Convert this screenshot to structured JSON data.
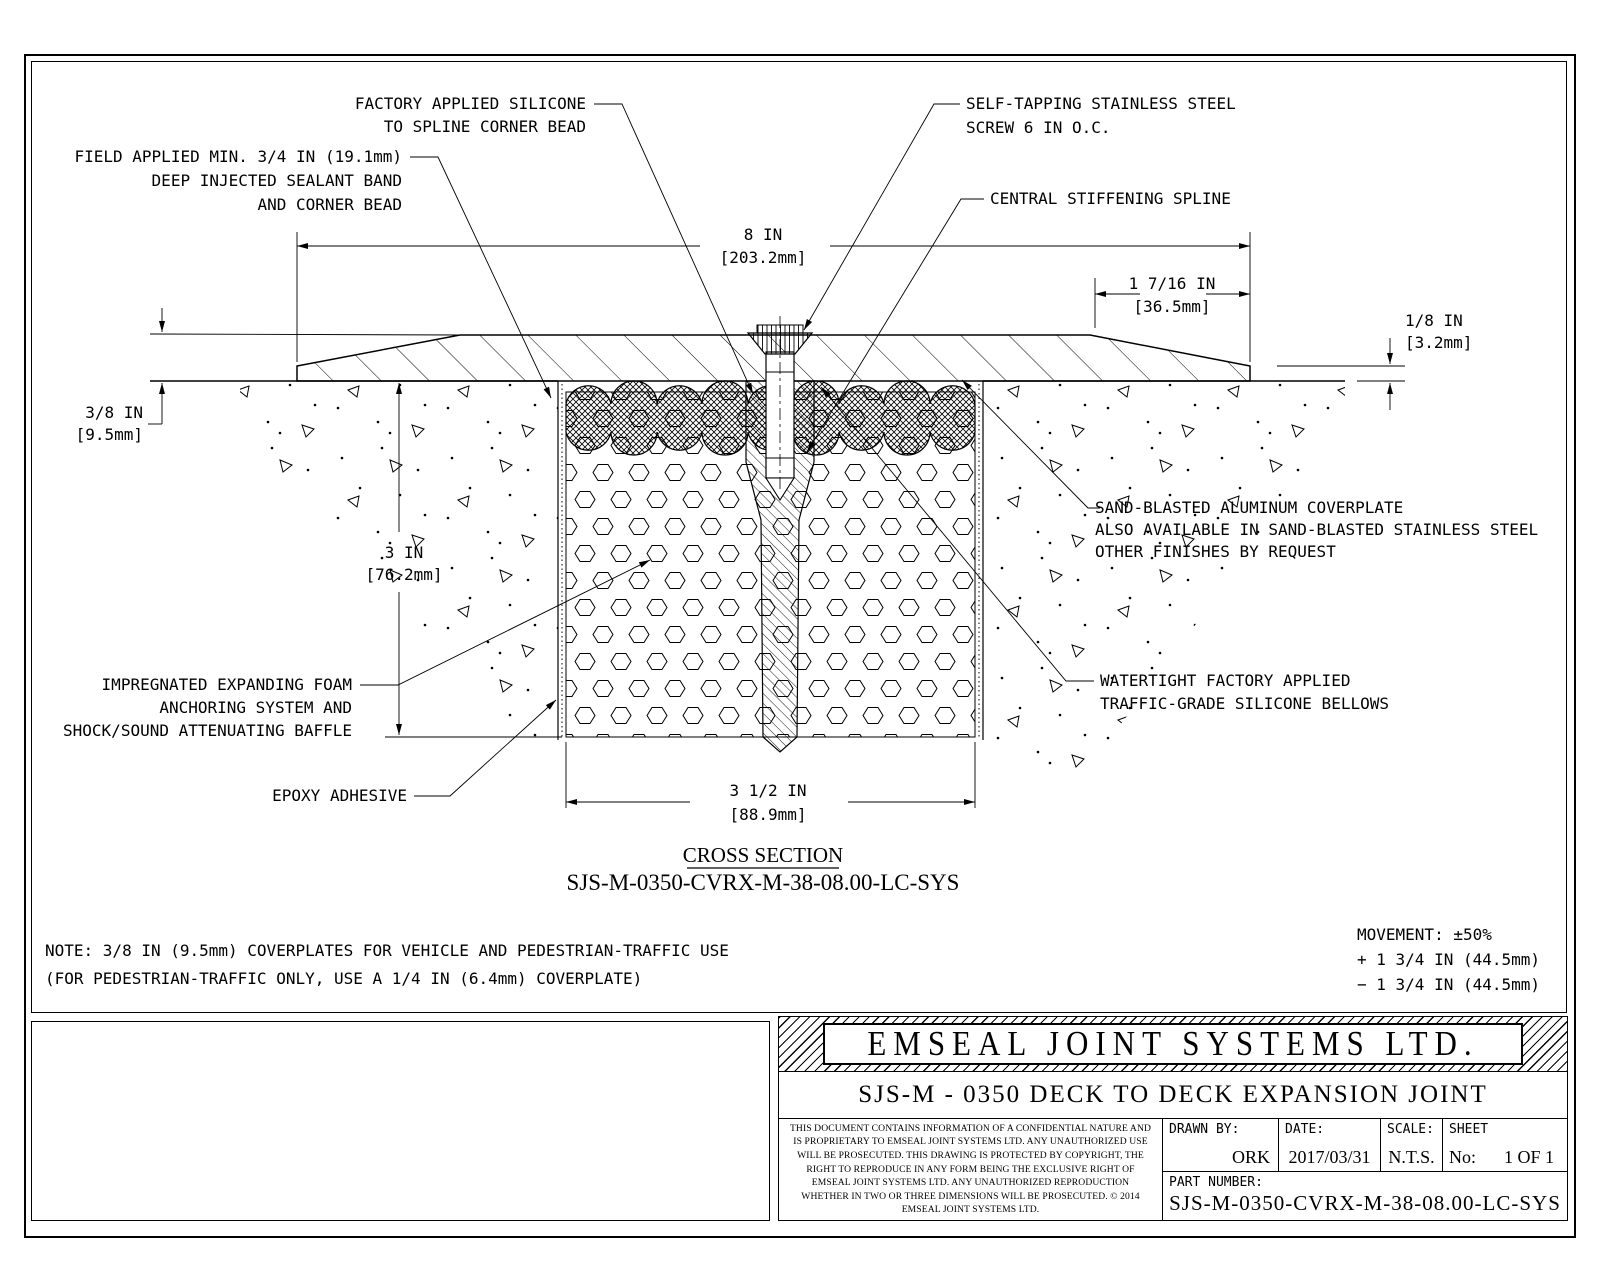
{
  "drawing": {
    "callouts": {
      "factory_applied": {
        "lines": [
          "FACTORY APPLIED SILICONE",
          "TO SPLINE CORNER BEAD"
        ]
      },
      "field_applied": {
        "lines": [
          "FIELD APPLIED MIN. 3/4 IN (19.1mm)",
          "DEEP INJECTED SEALANT BAND",
          "AND CORNER BEAD"
        ]
      },
      "self_tapping_screw": {
        "lines": [
          "SELF-TAPPING STAINLESS STEEL",
          "SCREW 6 IN O.C."
        ]
      },
      "central_spline": {
        "lines": [
          "CENTRAL STIFFENING SPLINE"
        ]
      },
      "coverplate": {
        "lines": [
          "SAND-BLASTED ALUMINUM COVERPLATE",
          "ALSO AVAILABLE IN SAND-BLASTED STAINLESS STEEL",
          "OTHER FINISHES BY REQUEST"
        ]
      },
      "bellows": {
        "lines": [
          "WATERTIGHT FACTORY APPLIED",
          "TRAFFIC-GRADE SILICONE BELLOWS"
        ]
      },
      "foam": {
        "lines": [
          "IMPREGNATED EXPANDING FOAM",
          "ANCHORING SYSTEM AND",
          "SHOCK/SOUND ATTENUATING BAFFLE"
        ]
      },
      "epoxy": {
        "lines": [
          "EPOXY ADHESIVE"
        ]
      }
    },
    "dimensions": {
      "overall_width": {
        "value": "8 IN",
        "metric": "[203.2mm]"
      },
      "taper_width": {
        "value": "1 7/16 IN",
        "metric": "[36.5mm]"
      },
      "edge_thickness": {
        "value": "1/8 IN",
        "metric": "[3.2mm]"
      },
      "plate_thickness": {
        "value": "3/8 IN",
        "metric": "[9.5mm]"
      },
      "depth": {
        "value": "3 IN",
        "metric": "[76.2mm]"
      },
      "joint_width": {
        "value": "3 1/2 IN",
        "metric": "[88.9mm]"
      }
    },
    "section_label": "CROSS SECTION",
    "section_code": "SJS-M-0350-CVRX-M-38-08.00-LC-SYS",
    "note_lines": [
      "NOTE: 3/8 IN (9.5mm) COVERPLATES FOR VEHICLE AND PEDESTRIAN-TRAFFIC USE",
      "(FOR PEDESTRIAN-TRAFFIC ONLY, USE A 1/4 IN (6.4mm) COVERPLATE)"
    ],
    "movement_lines": [
      "MOVEMENT: ±50%",
      "+ 1 3/4 IN (44.5mm)",
      "− 1 3/4 IN (44.5mm)"
    ]
  },
  "title_block": {
    "company": "EMSEAL JOINT SYSTEMS LTD.",
    "drawing_title": "SJS-M - 0350 DECK TO DECK EXPANSION JOINT",
    "confidential": "THIS DOCUMENT CONTAINS INFORMATION OF A CONFIDENTIAL NATURE AND IS PROPRIETARY TO EMSEAL JOINT SYSTEMS LTD. ANY UNAUTHORIZED USE WILL BE PROSECUTED. THIS DRAWING IS PROTECTED BY COPYRIGHT, THE RIGHT TO REPRODUCE IN ANY FORM BEING THE EXCLUSIVE RIGHT OF EMSEAL JOINT SYSTEMS LTD. ANY UNAUTHORIZED REPRODUCTION WHETHER IN TWO OR THREE DIMENSIONS WILL BE PROSECUTED. © 2014 EMSEAL JOINT SYSTEMS LTD.",
    "drawn_by_label": "DRAWN BY:",
    "drawn_by": "ORK",
    "date_label": "DATE:",
    "date": "2017/03/31",
    "scale_label": "SCALE:",
    "scale": "N.T.S.",
    "sheet_label": "SHEET",
    "sheet_no_label": "No:",
    "sheet": "1 OF 1",
    "part_number_label": "PART NUMBER:",
    "part_number": "SJS-M-0350-CVRX-M-38-08.00-LC-SYS"
  },
  "colors": {
    "line": "#000000",
    "paper": "#ffffff"
  }
}
